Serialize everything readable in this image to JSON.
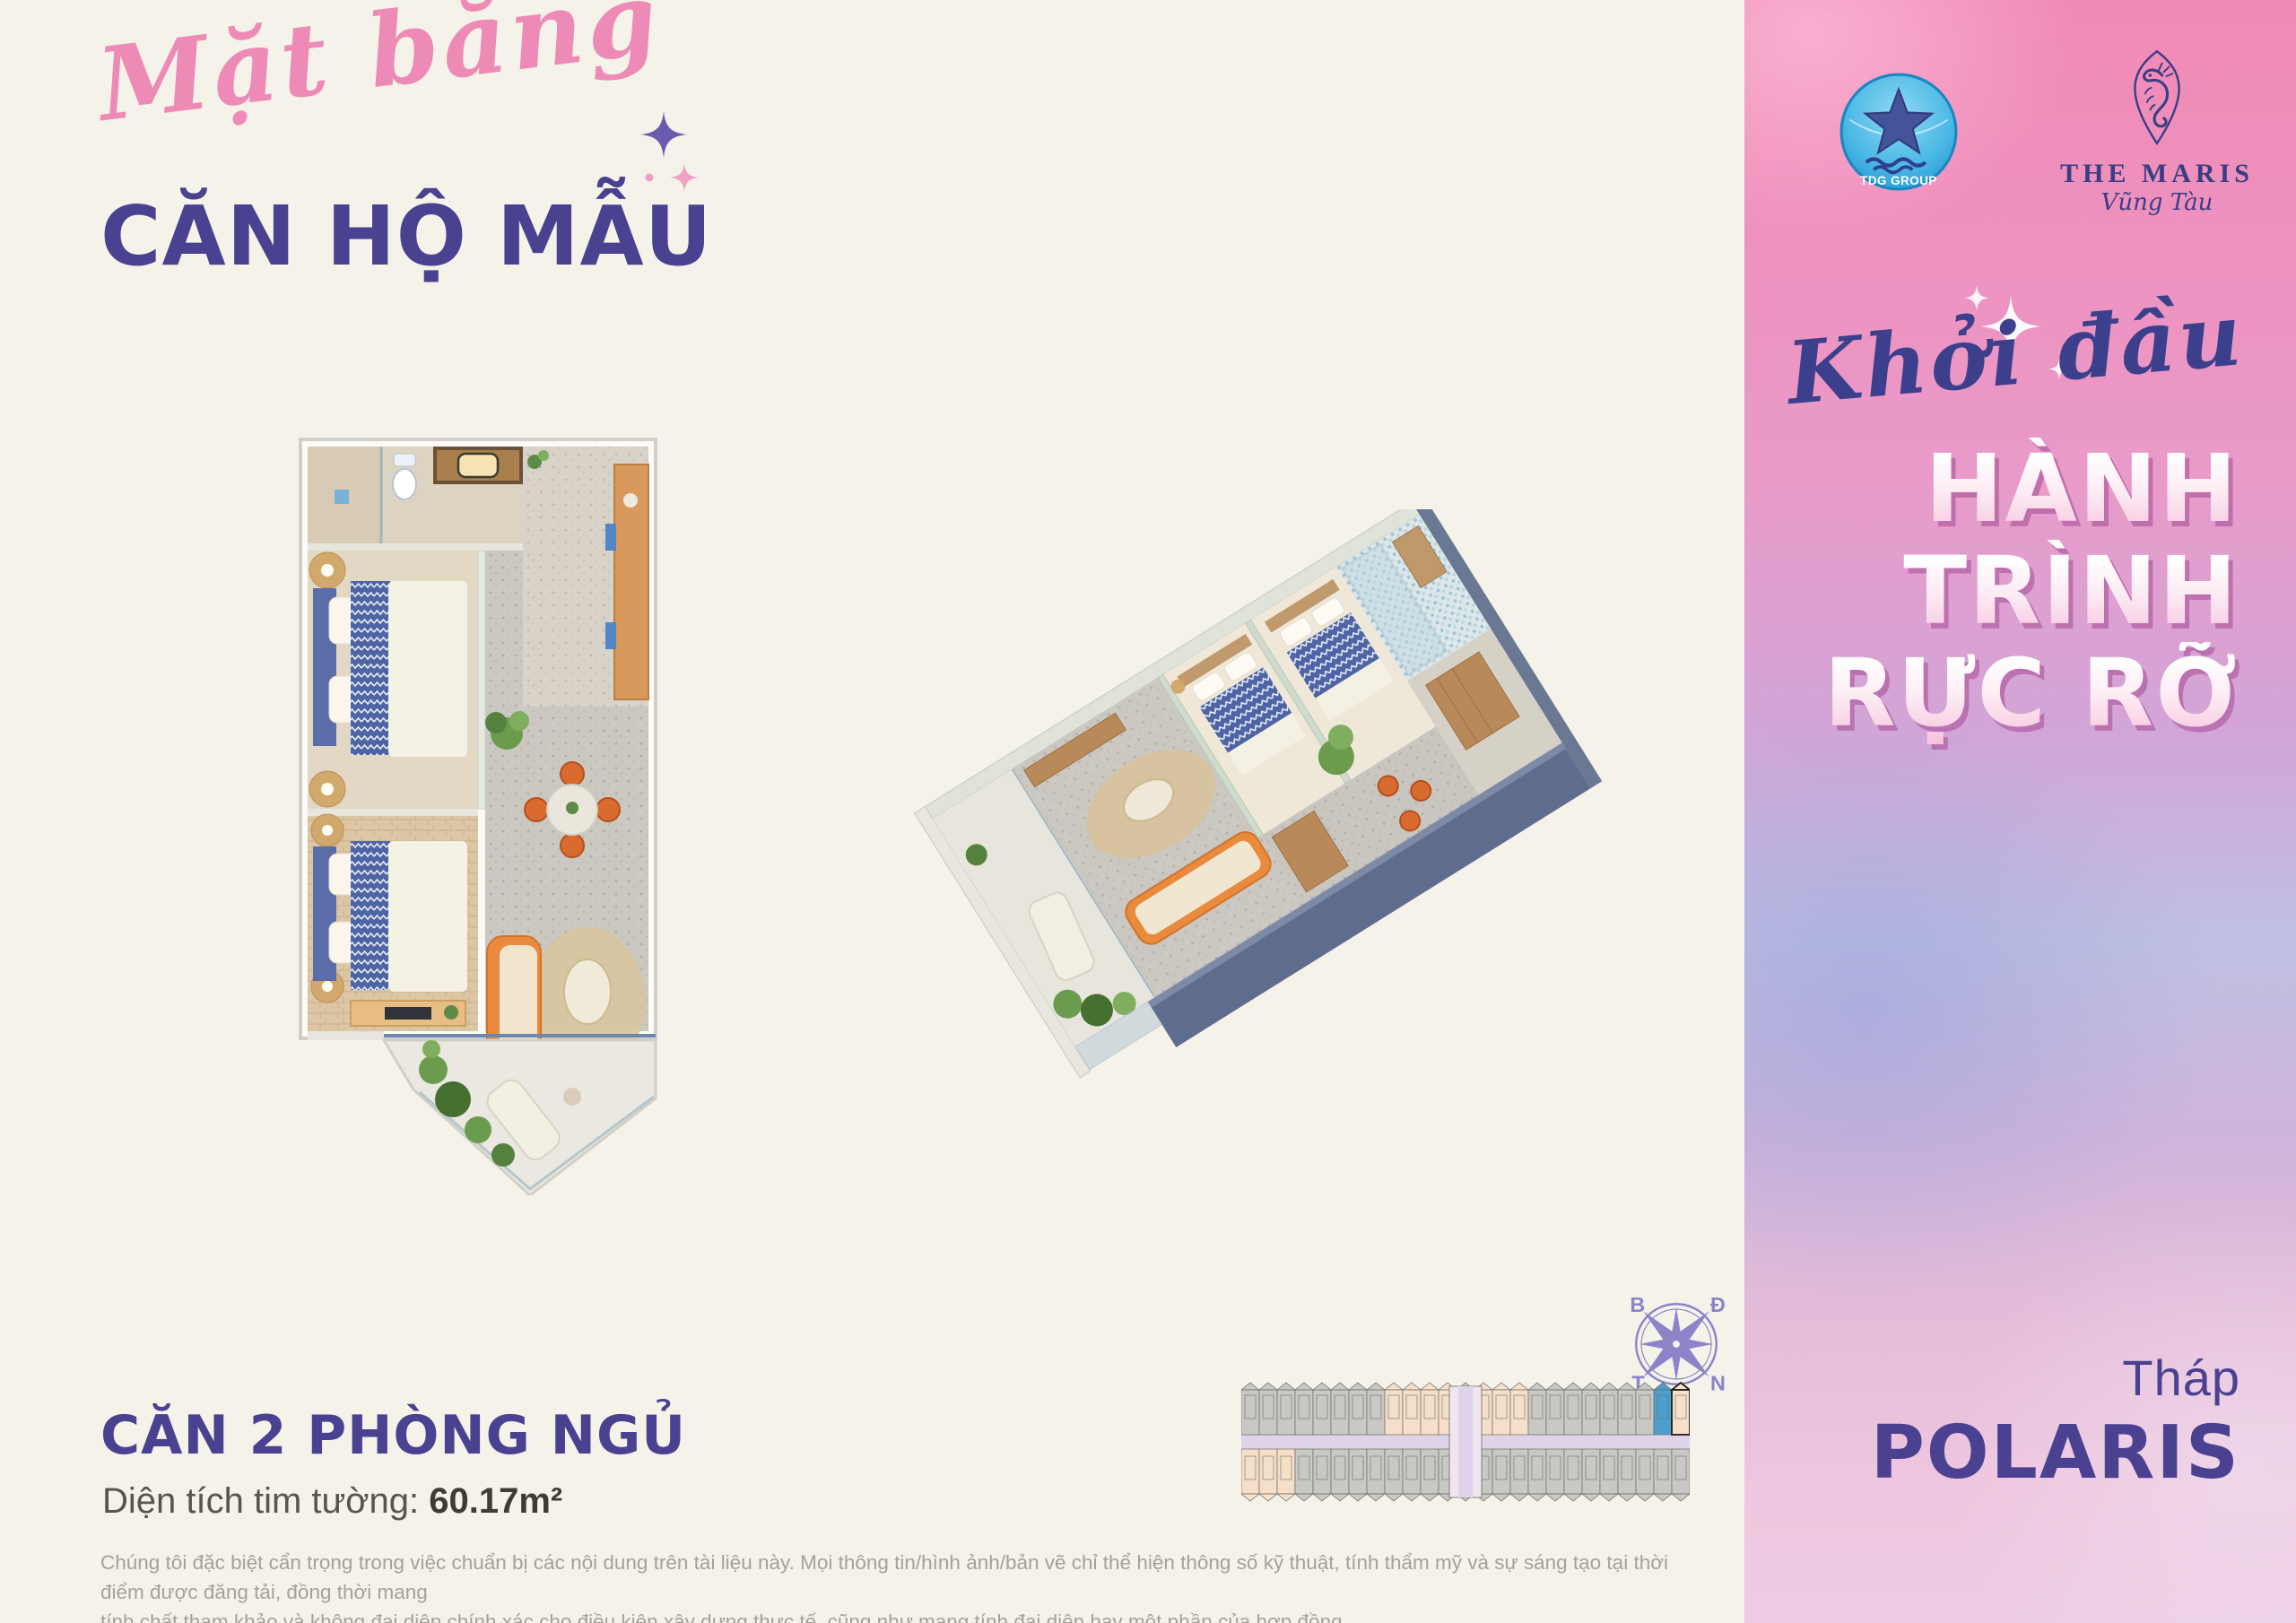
{
  "header": {
    "script_title": "Mặt bằng",
    "main_title": "CĂN HỘ MẪU"
  },
  "unit": {
    "name": "CĂN 2 PHÒNG NGỦ",
    "area_label": "Diện tích tim tường: ",
    "area_value": "60.17m²"
  },
  "disclaimer": {
    "lines": [
      "Chúng tôi đặc biệt cẩn trọng trong việc chuẩn bị các nội dung trên tài liệu này. Mọi thông tin/hình ảnh/bản vẽ chỉ thể hiện thông số kỹ thuật, tính thẩm mỹ và sự sáng tạo tại thời điểm được đăng tải, đồng thời mang",
      "tính chất tham khảo và không đại diện chính xác cho điều kiện xây dựng thực tế, cũng như mang tính đại diện hay một phần của hợp đồng"
    ]
  },
  "sidebar": {
    "script_title": "Khởi đầu",
    "headline": [
      "HÀNH",
      "TRÌNH",
      "RỰC RỠ"
    ],
    "tower_label": "Tháp",
    "tower_name": "POLARIS",
    "logos": {
      "tdg_label": "TDG GROUP",
      "maris_title": "THE MARIS",
      "maris_subtitle": "Vũng Tàu"
    },
    "accent_colors": {
      "panel_pink": "#f08ab4",
      "panel_lavender": "#bfc0e2",
      "headline_shadow": "#a44896",
      "navy": "#3c3f8c"
    }
  },
  "compass": {
    "north": "B",
    "east": "Đ",
    "west": "T",
    "south": "N"
  },
  "locator": {
    "units": 25,
    "core_index": 12,
    "upper_peach": [
      8,
      9,
      10,
      11,
      13,
      14,
      15
    ],
    "lower_peach": [
      0,
      1,
      2
    ],
    "highlight_index": 23,
    "outlined_index": 24,
    "colors": {
      "unit": "#c9c8c4",
      "outline": "#6b6b66",
      "peach": "#f6dfc9",
      "blue": "#4c9fcd",
      "corridor": "#ded3e8",
      "core": "#efe6f0",
      "highlight_outline": "#1c1c1c"
    }
  },
  "palette": {
    "background": "#f4f2e9",
    "title_purple": "#4a4191",
    "script_pink": "#ee8ab6",
    "wall_slate": "#5e6c8d",
    "sofa_orange": "#e98a3c",
    "bed_blue": "#5468a6"
  }
}
